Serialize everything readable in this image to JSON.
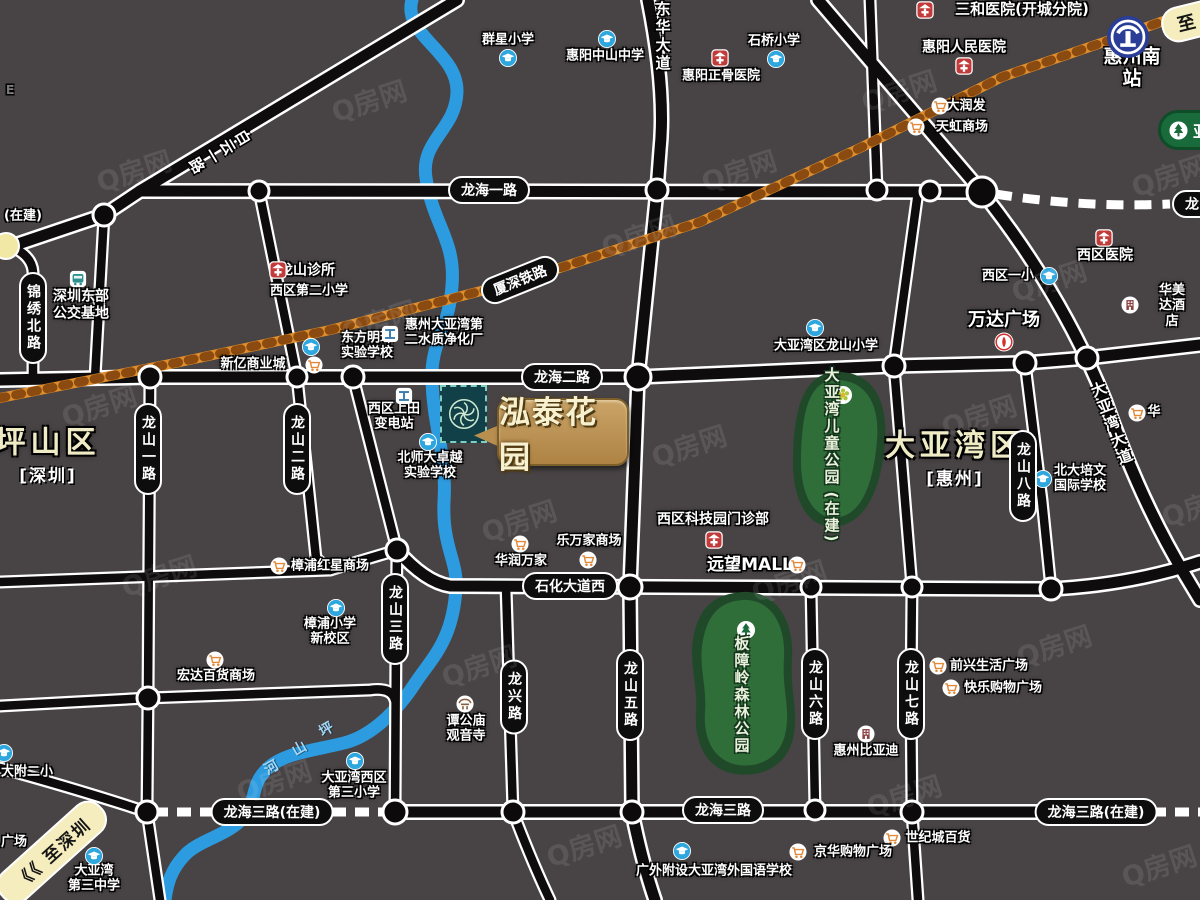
{
  "project": {
    "name": "泓泰花园"
  },
  "watermark": {
    "text": "Q房网"
  },
  "areas": [
    {
      "name": "坪山区",
      "sub": "[深圳]",
      "x": 48,
      "y": 452
    },
    {
      "name": "大亚湾区",
      "sub": "[惠州]",
      "x": 955,
      "y": 455
    }
  ],
  "road_pills": [
    {
      "label": "龙海一路",
      "x": 489,
      "y": 190,
      "o": "h"
    },
    {
      "label": "龙海二路",
      "x": 562,
      "y": 377,
      "o": "h"
    },
    {
      "label": "石化大道西",
      "x": 570,
      "y": 586,
      "o": "h"
    },
    {
      "label": "龙海三路(在建)",
      "x": 272,
      "y": 812,
      "o": "h"
    },
    {
      "label": "龙海三路",
      "x": 723,
      "y": 810,
      "o": "h"
    },
    {
      "label": "龙海三路(在建)",
      "x": 1096,
      "y": 812,
      "o": "h"
    },
    {
      "label": "厦深铁路",
      "x": 520,
      "y": 280,
      "o": "h",
      "rot": -22
    },
    {
      "label": "龙",
      "x": 1192,
      "y": 204,
      "o": "h"
    },
    {
      "label": "锦绣北路",
      "x": 33,
      "y": 318,
      "o": "v"
    },
    {
      "label": "龙山一路",
      "x": 148,
      "y": 449,
      "o": "v"
    },
    {
      "label": "龙山二路",
      "x": 297,
      "y": 449,
      "o": "v"
    },
    {
      "label": "龙山三路",
      "x": 395,
      "y": 619,
      "o": "v"
    },
    {
      "label": "龙兴路",
      "x": 514,
      "y": 697,
      "o": "v"
    },
    {
      "label": "龙山五路",
      "x": 630,
      "y": 695,
      "o": "v"
    },
    {
      "label": "龙山六路",
      "x": 815,
      "y": 694,
      "o": "v"
    },
    {
      "label": "龙山七路",
      "x": 911,
      "y": 694,
      "o": "v"
    },
    {
      "label": "龙山八路",
      "x": 1023,
      "y": 476,
      "o": "v"
    }
  ],
  "road_names": [
    {
      "t": "东华大道",
      "x": 663,
      "y": 37,
      "rot": 0
    },
    {
      "t": "大亚湾大道",
      "x": 1112,
      "y": 424,
      "rot": -21
    },
    {
      "t": "白云一路",
      "x": 219,
      "y": 152,
      "rot": 59
    }
  ],
  "river": {
    "name": "坪山河"
  },
  "pois": [
    {
      "t": "群星小学",
      "x": 508,
      "y": 40,
      "icon": "school",
      "ix": 508,
      "iy": 58
    },
    {
      "t": "惠阳中山中学",
      "x": 605,
      "y": 56,
      "icon": "school",
      "ix": 607,
      "iy": 39
    },
    {
      "t": "石桥小学",
      "x": 774,
      "y": 41,
      "icon": "school",
      "ix": 776,
      "iy": 59
    },
    {
      "t": "惠阳正骨医院",
      "x": 721,
      "y": 76,
      "icon": "hospital",
      "ix": 720,
      "iy": 58
    },
    {
      "t": "三和医院(开城分院)",
      "x": 1022,
      "y": 10,
      "size": 15,
      "icon": "hospital",
      "ix": 925,
      "iy": 10
    },
    {
      "t": "惠阳人民医院",
      "x": 964,
      "y": 48,
      "size": 14,
      "icon": "hospital",
      "ix": 964,
      "iy": 66
    },
    {
      "t": "惠州南站",
      "x": 1132,
      "y": 68,
      "size": 19,
      "icon": "train",
      "ix": 1128,
      "iy": 37
    },
    {
      "t": "大润发",
      "x": 966,
      "y": 106,
      "icon": "cart",
      "ix": 940,
      "iy": 106
    },
    {
      "t": "天虹商场",
      "x": 962,
      "y": 127,
      "icon": "cart",
      "ix": 916,
      "iy": 127
    },
    {
      "t": "西区医院",
      "x": 1105,
      "y": 256,
      "size": 14,
      "icon": "hospital",
      "ix": 1104,
      "iy": 238
    },
    {
      "t": "西区一小",
      "x": 1008,
      "y": 276,
      "icon": "school",
      "ix": 1049,
      "iy": 276
    },
    {
      "t": "华美达酒店",
      "x": 1172,
      "y": 306,
      "icon": "building",
      "ix": 1130,
      "iy": 305
    },
    {
      "t": "龙山诊所",
      "x": 307,
      "y": 271,
      "size": 14,
      "icon": "hospital",
      "ix": 278,
      "iy": 270
    },
    {
      "t": "西区第二小学",
      "x": 309,
      "y": 291
    },
    {
      "t": "深圳东部\n公交基地",
      "x": 81,
      "y": 305,
      "size": 14,
      "icon": "bus",
      "ix": 78,
      "iy": 279
    },
    {
      "t": "东方明珠\n实验学校",
      "x": 367,
      "y": 346,
      "icon": "school",
      "ix": 311,
      "iy": 347
    },
    {
      "t": "惠州大亚湾第\n二水质净化厂",
      "x": 444,
      "y": 333,
      "icon": "factory",
      "ix": 390,
      "iy": 334
    },
    {
      "t": "新亿商业城",
      "x": 253,
      "y": 364,
      "icon": "cart",
      "ix": 314,
      "iy": 365
    },
    {
      "t": "万达广场",
      "x": 1004,
      "y": 320,
      "size": 18,
      "icon": "wanda",
      "ix": 1004,
      "iy": 342
    },
    {
      "t": "大亚湾区龙山小学",
      "x": 826,
      "y": 346,
      "icon": "school",
      "ix": 815,
      "iy": 328
    },
    {
      "t": "西区上田\n变电站",
      "x": 394,
      "y": 417,
      "icon": "factory",
      "ix": 404,
      "iy": 396
    },
    {
      "t": "北师大卓越\n实验学校",
      "x": 430,
      "y": 466,
      "icon": "school",
      "ix": 428,
      "iy": 442
    },
    {
      "t": "北大培文\n国际学校",
      "x": 1080,
      "y": 479,
      "icon": "school",
      "ix": 1043,
      "iy": 479
    },
    {
      "t": "西区科技园门诊部",
      "x": 713,
      "y": 520,
      "size": 14,
      "icon": "hospital",
      "ix": 714,
      "iy": 540
    },
    {
      "t": "乐万家商场",
      "x": 589,
      "y": 541,
      "icon": "cart",
      "ix": 588,
      "iy": 560
    },
    {
      "t": "华润万家",
      "x": 521,
      "y": 561,
      "icon": "cart",
      "ix": 520,
      "iy": 544
    },
    {
      "t": "远望MALL",
      "x": 750,
      "y": 565,
      "size": 17,
      "icon": "cart",
      "ix": 797,
      "iy": 565
    },
    {
      "t": "樟浦红星商场",
      "x": 330,
      "y": 566,
      "icon": "cart",
      "ix": 279,
      "iy": 566
    },
    {
      "t": "樟浦小学\n新校区",
      "x": 330,
      "y": 632,
      "icon": "school",
      "ix": 336,
      "iy": 608
    },
    {
      "t": "宏达百货商场",
      "x": 216,
      "y": 676,
      "icon": "cart",
      "ix": 215,
      "iy": 660
    },
    {
      "t": "谭公庙\n观音寺",
      "x": 466,
      "y": 729,
      "icon": "temple",
      "ix": 465,
      "iy": 704
    },
    {
      "t": "前兴生活广场",
      "x": 989,
      "y": 666,
      "icon": "cart",
      "ix": 938,
      "iy": 666
    },
    {
      "t": "快乐购物广场",
      "x": 1003,
      "y": 688,
      "icon": "cart",
      "ix": 951,
      "iy": 688
    },
    {
      "t": "惠州比亚迪",
      "x": 866,
      "y": 751,
      "icon": "building",
      "ix": 866,
      "iy": 734
    },
    {
      "t": "大附二小",
      "x": 27,
      "y": 772,
      "icon": "school",
      "ix": 4,
      "iy": 753
    },
    {
      "t": "大亚湾西区\n第三小学",
      "x": 354,
      "y": 786,
      "icon": "school",
      "ix": 355,
      "iy": 761
    },
    {
      "t": "大亚湾\n第三中学",
      "x": 94,
      "y": 879,
      "icon": "school",
      "ix": 94,
      "iy": 856
    },
    {
      "t": "世纪城百货",
      "x": 938,
      "y": 838,
      "icon": "cart",
      "ix": 892,
      "iy": 838
    },
    {
      "t": "京华购物广场",
      "x": 853,
      "y": 852,
      "icon": "cart",
      "ix": 798,
      "iy": 852
    },
    {
      "t": "广外附设大亚湾外国语学校",
      "x": 714,
      "y": 871,
      "icon": "school",
      "ix": 682,
      "iy": 851
    },
    {
      "t": "华",
      "x": 1154,
      "y": 412,
      "icon": "cart",
      "ix": 1137,
      "iy": 413
    }
  ],
  "parks": {
    "children": {
      "name": "大亚湾儿童公园",
      "status": "(在建)"
    },
    "banzhang": {
      "name": "板障岭森林公园"
    },
    "yagongding": {
      "name": "亚"
    }
  },
  "signs": [
    {
      "t": "至",
      "x": 1192,
      "y": 21,
      "style": "yellow"
    },
    {
      "t": "《《 至深圳",
      "x": 52,
      "y": 852,
      "style": "yellow-sz"
    },
    {
      "t": "(在建)",
      "x": 23,
      "y": 214,
      "style": "plain"
    },
    {
      "t": "广场",
      "x": 14,
      "y": 840,
      "style": "plain"
    },
    {
      "t": "E",
      "x": 10,
      "y": 90,
      "style": "faint"
    }
  ]
}
